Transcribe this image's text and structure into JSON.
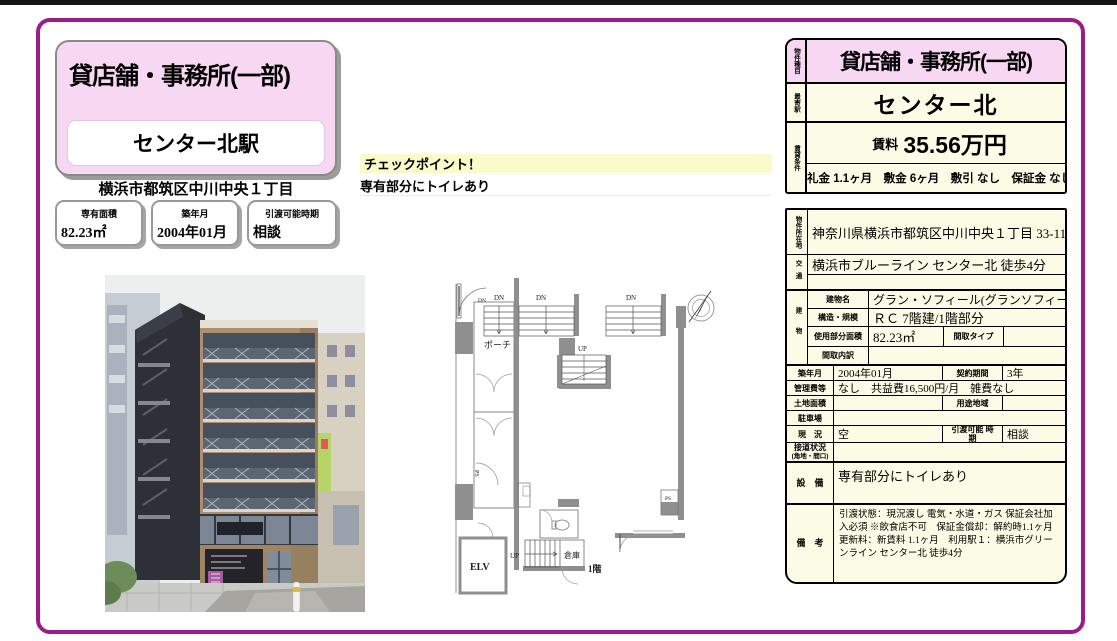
{
  "header_card": {
    "property_type": "貸店舗・事務所(一部)",
    "station": "センター北駅",
    "address": "横浜市都筑区中川中央１丁目"
  },
  "summary_boxes": [
    {
      "label": "専有面積",
      "value": "82.23㎡"
    },
    {
      "label": "築年月",
      "value": "2004年01月"
    },
    {
      "label": "引渡可能時期",
      "value": "相談"
    }
  ],
  "checkpoint": {
    "title": "チェックポイント！",
    "note": "専有部分にトイレあり"
  },
  "price_table": {
    "type_label": "物件種目",
    "type": "貸店舗・事務所(一部)",
    "station_label": "最寄駅",
    "station": "センター北",
    "terms_label": "賃貸条件",
    "rent_label": "賃料",
    "rent": "35.56万円",
    "terms": "礼金 1.1ヶ月　敷金 6ヶ月　敷引 なし　保証金 なし"
  },
  "property_table": {
    "location": {
      "label": "物件所在地",
      "value": "神奈川県横浜市都筑区中川中央１丁目 33-11"
    },
    "access": {
      "label": "交通",
      "line1": "横浜市ブルーライン センター北 徒歩4分",
      "line2": ""
    },
    "building": {
      "label": "建物",
      "name_label": "建物名",
      "name": "グラン・ソフィール(グランソフィール)",
      "structure_label": "構造・規模",
      "structure": "ＲＣ 7階建/1階部分",
      "area_label": "使用部分面積",
      "area": "82.23㎡",
      "layout_type_label": "間取タイプ",
      "layout_type": "",
      "layout_detail_label": "間取内訳",
      "layout_detail": ""
    },
    "built": {
      "label": "築年月",
      "value": "2004年01月",
      "contract_label": "契約期間",
      "contract": "3年"
    },
    "fees": {
      "label": "管理費等",
      "value": "なし　共益費16,500円/月　雑費なし"
    },
    "land": {
      "label": "土地面積",
      "value": "",
      "zoning_label": "用途地域",
      "zoning": ""
    },
    "parking": {
      "label": "駐車場",
      "value": ""
    },
    "status": {
      "label": "現　況",
      "value": "空",
      "handover_label": "引渡可能 時期",
      "handover": "相談"
    },
    "road": {
      "label": "接道状況",
      "label2": "(角地・間口)",
      "value": ""
    },
    "equipment": {
      "label": "設　備",
      "value": "専有部分にトイレあり"
    },
    "remarks": {
      "label": "備　考",
      "value": "引渡状態：現況渡し 電気・水道・ガス 保証会社加入必須 ※飲食店不可　保証金償却：解約時1.1ヶ月　更新料：新賃料 1.1ヶ月　利用駅１：横浜市グリーンライン センター北 徒歩4分"
    }
  },
  "floorplan": {
    "porch": "ポーチ",
    "up": "UP",
    "down": "DN",
    "ps": "PS",
    "elevator": "ELV",
    "storage": "倉庫",
    "floor": "1階"
  },
  "colors": {
    "accent_purple": "#9A1C8C",
    "pink": "#F8D7F2",
    "cream": "#FCFCE6",
    "checkpoint_yellow": "#FAFACB"
  }
}
